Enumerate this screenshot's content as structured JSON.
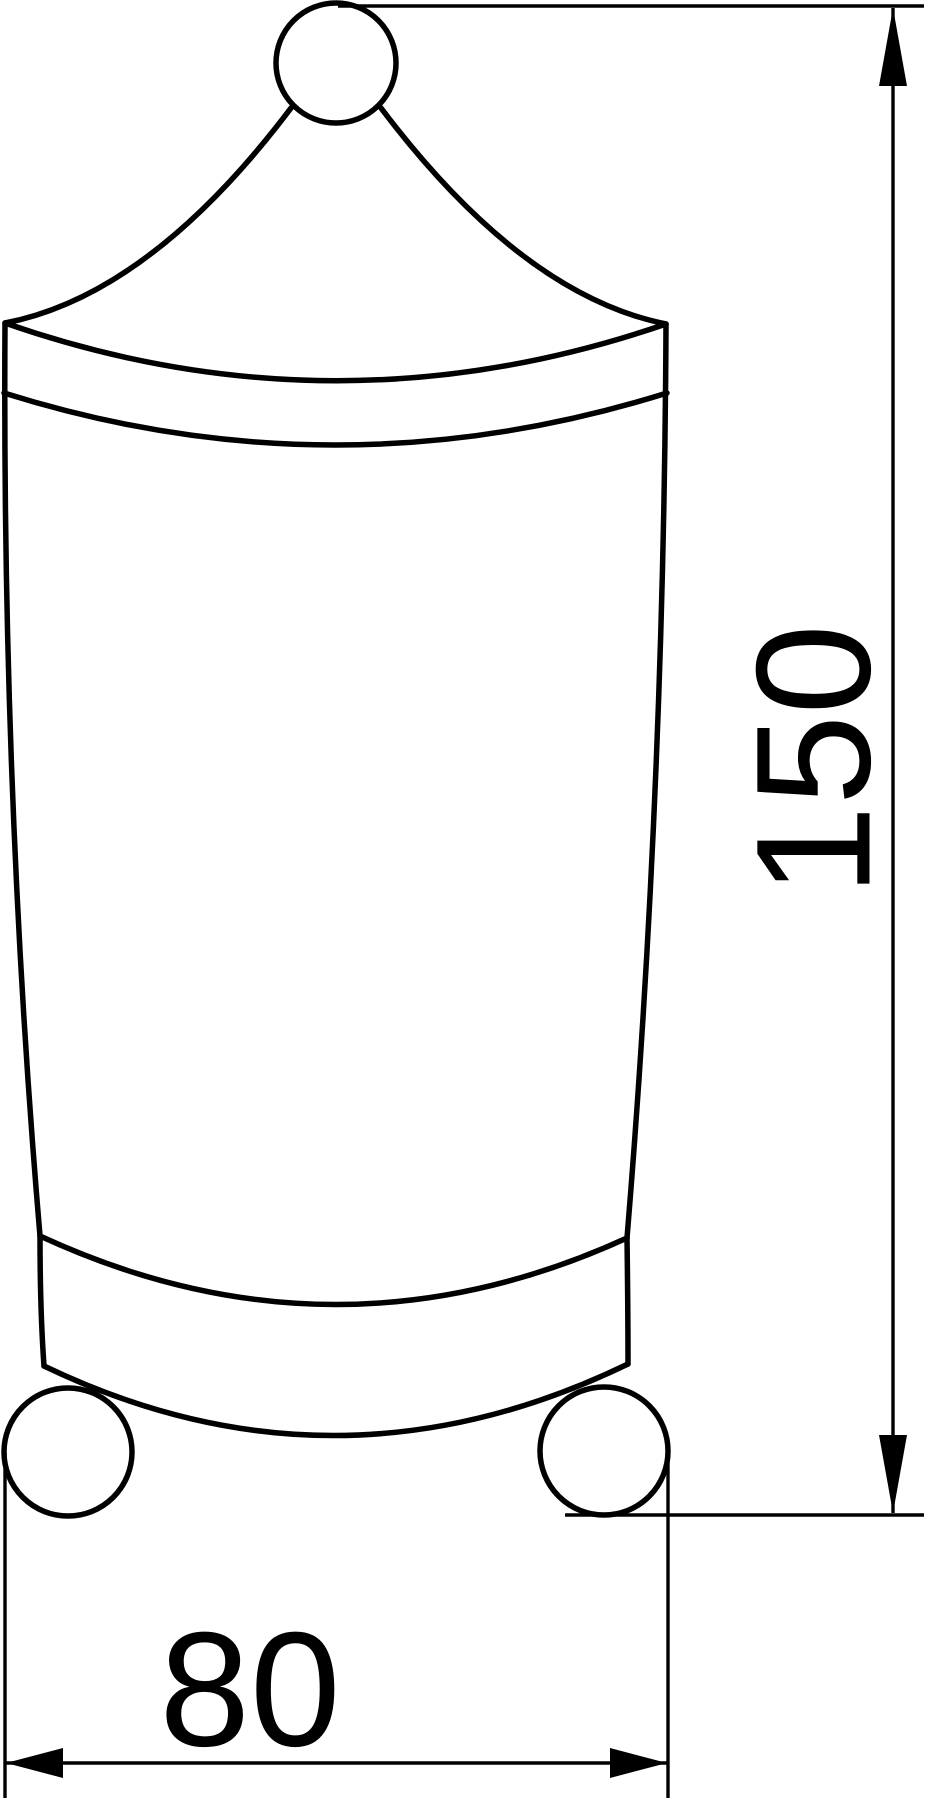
{
  "drawing": {
    "background_color": "#ffffff",
    "line_color": "#000000",
    "dimensions": {
      "height": {
        "value": "150",
        "orientation": "vertical"
      },
      "width": {
        "value": "80",
        "orientation": "horizontal"
      }
    }
  }
}
